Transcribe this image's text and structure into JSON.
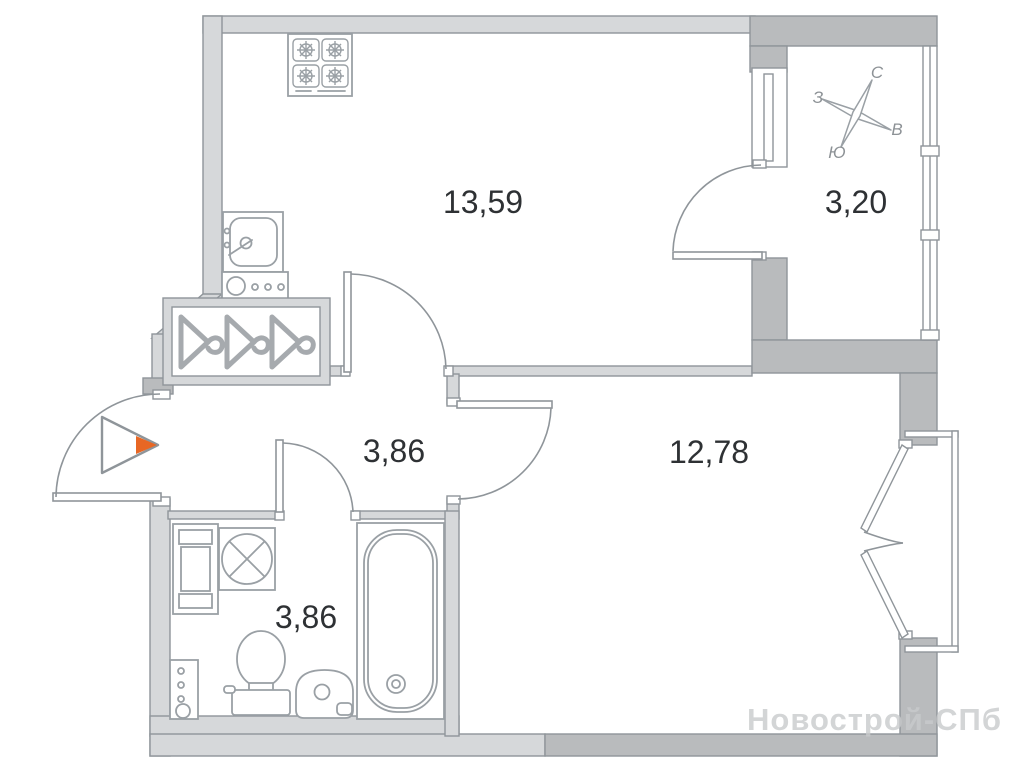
{
  "plan": {
    "type": "apartment-floor-plan",
    "rooms": [
      {
        "id": "kitchen-living",
        "area": "13,59"
      },
      {
        "id": "loggia",
        "area": "3,20"
      },
      {
        "id": "hallway",
        "area": "3,86"
      },
      {
        "id": "living-room",
        "area": "12,78"
      },
      {
        "id": "bathroom",
        "area": "3,86"
      }
    ],
    "compass": {
      "north": "С",
      "east": "В",
      "south": "Ю",
      "west": "З"
    },
    "watermark": "Новострой-СПб",
    "colors": {
      "wall_light": "#d6d8da",
      "wall_dark": "#b9bbbd",
      "outline": "#8f959a",
      "label_text": "#2e3134",
      "accent_orange": "#e86724",
      "compass_text": "#8d9296",
      "watermark_gray": "#c9cbcd"
    }
  }
}
